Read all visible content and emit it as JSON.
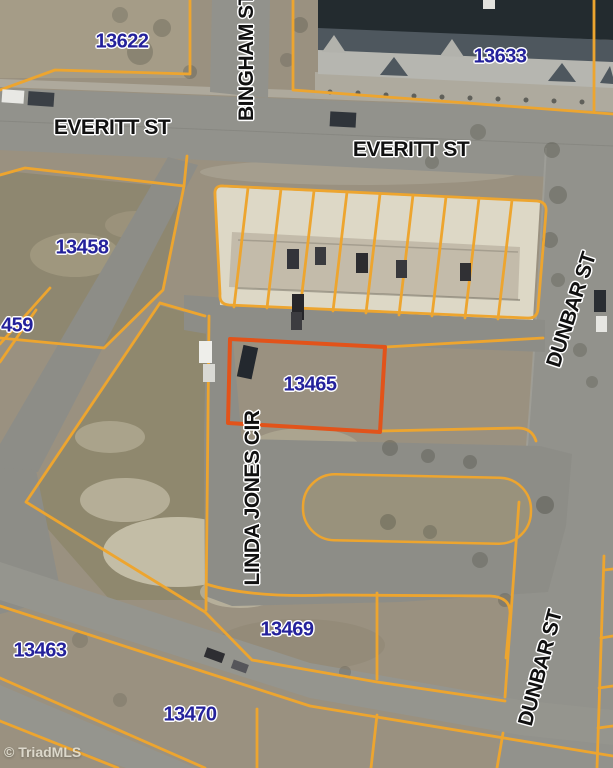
{
  "map": {
    "watermark": "© TriadMLS",
    "highlight_parcel": "13465",
    "parcel_labels": [
      {
        "id": "13622",
        "text": "13622"
      },
      {
        "id": "13633",
        "text": "13633"
      },
      {
        "id": "13458",
        "text": "13458"
      },
      {
        "id": "13459-partial",
        "text": "459"
      },
      {
        "id": "13465",
        "text": "13465"
      },
      {
        "id": "13469",
        "text": "13469"
      },
      {
        "id": "13463",
        "text": "13463"
      },
      {
        "id": "13470",
        "text": "13470"
      }
    ],
    "street_labels": [
      {
        "id": "everitt-west",
        "text": "EVERITT ST"
      },
      {
        "id": "everitt-east",
        "text": "EVERITT ST"
      },
      {
        "id": "bingham",
        "text": "BINGHAM ST"
      },
      {
        "id": "linda-jones-cir",
        "text": "LINDA JONES CIR"
      },
      {
        "id": "dunbar-north",
        "text": "DUNBAR ST"
      },
      {
        "id": "dunbar-south",
        "text": "DUNBAR ST"
      }
    ],
    "colors": {
      "parcel_line": "#eda52f",
      "highlight_border": "#e2531a",
      "parcel_label": "#24219b",
      "street_label": "#101010"
    }
  }
}
